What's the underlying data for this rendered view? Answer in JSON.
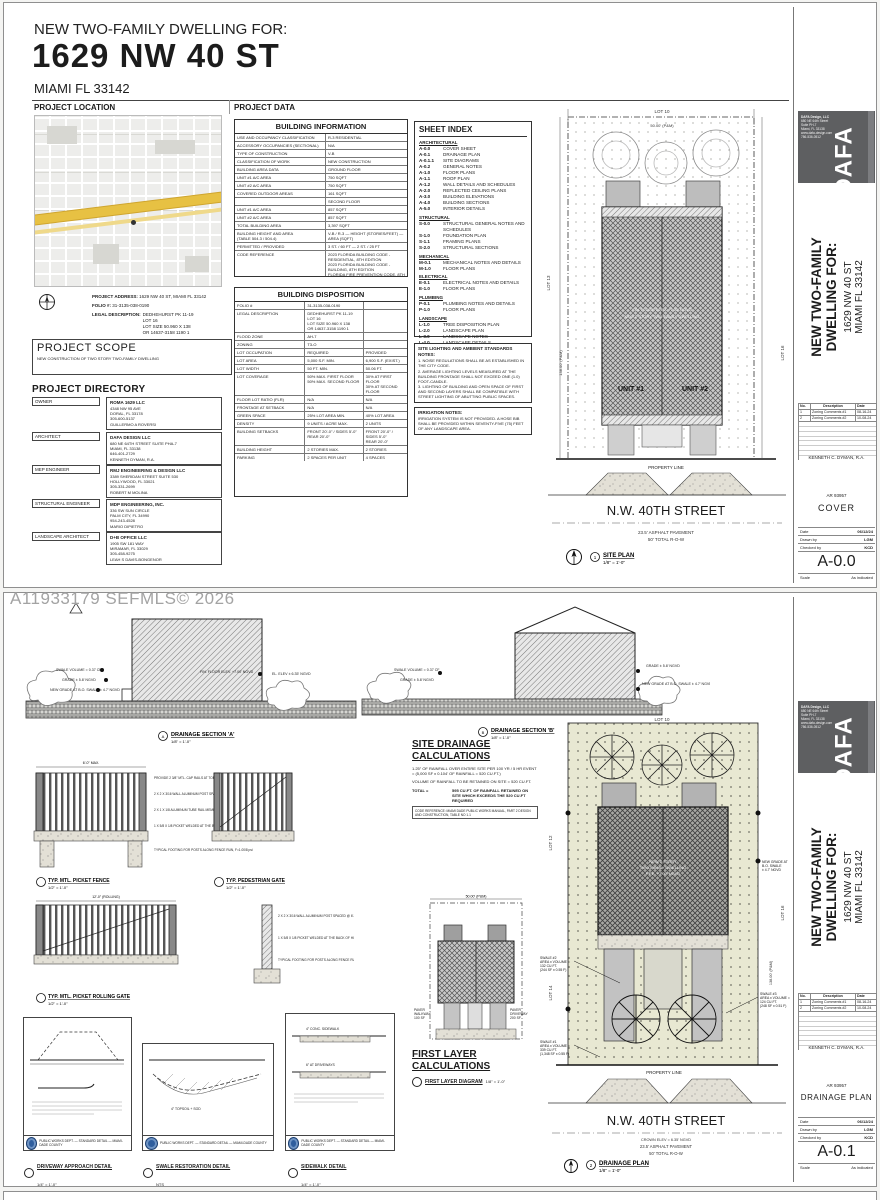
{
  "watermark": "A11933179  SEFMLS© 2026",
  "header": {
    "pretitle": "NEW TWO-FAMILY DWELLING FOR:",
    "title": "1629 NW 40 ST",
    "subtitle": "MIAMI FL 33142",
    "section_left": "PROJECT LOCATION",
    "section_right": "PROJECT DATA"
  },
  "project_info": {
    "address_label": "PROJECT ADDRESS:",
    "address": "1629 NW 40 ST, MIAMI FL 33142",
    "folio_label": "FOLIO #:",
    "folio": "31-3135-038-0190",
    "legal_label": "LEGAL DESCRIPTION:",
    "legal": "DEDHEHURST PK 11-19\nLOT 16\nLOT SIZE 50.960 X 138\nOR 14637-3158 1190 1"
  },
  "project_scope": {
    "title": "PROJECT SCOPE",
    "text": "NEW CONSTRUCTION OF TWO STORY TWO-FAMILY DWELLING"
  },
  "project_directory": {
    "title": "PROJECT DIRECTORY",
    "entries": [
      {
        "role": "OWNER",
        "name": "ROMA 1629 LLC",
        "lines": "4348 NW 95 AVE\nDORAL, FL 33178\n305-600-5137\nGUILLERMO A ROVERSI"
      },
      {
        "role": "ARCHITECT",
        "name": "DAFA DESIGN LLC",
        "lines": "680 NE 64TH STREET SUITE PHA-7\nMIAMI, FL 33138\n646-401-2729\nKENNETH DYMAN, R.A."
      },
      {
        "role": "MEP ENGINEER",
        "name": "RMJ ENGINEERING & DESIGN LLC",
        "lines": "3389 SHERIDAN STREET SUITE 530\nHOLLYWOOD, FL 33021\n305-331-2699\nROBERT M MOLINA"
      },
      {
        "role": "STRUCTURAL ENGINEER",
        "name": "MDP ENGINEERING, INC.",
        "lines": "336 SW SUN CIRCLE\nPALM CITY, FL 34990\n954-243-4528\nMARIO DIPIETRO"
      },
      {
        "role": "LANDSCAPE ARCHITECT",
        "name": "D+B OFFICE LLC",
        "lines": "1905 SW 181 WAY\nMIRAMAR, FL 33029\n305-458-9275\nLEAH S DAVIS-BONGENOR"
      }
    ]
  },
  "building_information": {
    "title": "BUILDING INFORMATION",
    "rows": [
      [
        "USE AND OCCUPANCY CLASSIFICATION",
        "R-3 RESIDENTIAL"
      ],
      [
        "ACCESSORY OCCUPANCIES (SECTIONAL)",
        "N/A"
      ],
      [
        "TYPE OF CONSTRUCTION",
        "V-B"
      ],
      [
        "CLASSIFICATION OF WORK",
        "NEW CONSTRUCTION"
      ],
      [
        "BUILDING AREA DATA",
        "GROUND FLOOR"
      ],
      [
        "UNIT #1 A/C AREA",
        "750 SQFT"
      ],
      [
        "UNIT #2 A/C AREA",
        "750 SQFT"
      ],
      [
        "COVERED OUTDOOR AREAS",
        "161 SQFT"
      ],
      [
        "",
        "SECOND FLOOR"
      ],
      [
        "UNIT #1 A/C AREA",
        "857 SQFT"
      ],
      [
        "UNIT #2 A/C AREA",
        "857 SQFT"
      ],
      [
        "TOTAL BUILDING AREA",
        "3,397 SQFT"
      ],
      [
        "BUILDING HEIGHT AND AREA\n(TABLE 504.3 / 504.4)",
        "V-B / R-3  —  HEIGHT (STORIES/FEET)  —  AREA (SQFT)"
      ],
      [
        "PERMITTED / PROVIDED",
        "3 ST. / 60 FT  —  2 ST. / 25 FT"
      ],
      [
        "CODE REFERENCE",
        "2023 FLORIDA BUILDING CODE - RESIDENTIAL, 8TH EDITION\n2023 FLORIDA BUILDING CODE - BUILDING, 8TH EDITION\nFLORIDA FIRE PREVENTION CODE, 8TH EDITION"
      ]
    ]
  },
  "building_disposition": {
    "title": "BUILDING DISPOSITION",
    "rows": [
      [
        "FOLIO #",
        "31-3135-038-0190",
        ""
      ],
      [
        "LEGAL DESCRIPTION",
        "DEDHEHURST PK 11-19\nLOT 16\nLOT SIZE 50.960 X 138\nOR 14637-3158 1190 1",
        ""
      ],
      [
        "FLOOD ZONE",
        "AH-7",
        ""
      ],
      [
        "ZONING",
        "T3-O",
        ""
      ],
      [
        "LOT OCCUPATION",
        "REQUIRED",
        "PROVIDED"
      ],
      [
        "LOT AREA",
        "5,000 S.F. MIN.",
        "6,900 S.F. (EXIST.)"
      ],
      [
        "LOT WIDTH",
        "50 FT. MIN.",
        "50.06 FT."
      ],
      [
        "LOT COVERAGE",
        "50% MAX. FIRST FLOOR\n50% MAX. SECOND FLOOR",
        "30% AT FIRST FLOOR\n30% AT SECOND FLOOR"
      ],
      [
        "FLOOR LOT RATIO (FLR)",
        "N/A",
        "N/A"
      ],
      [
        "FRONTAGE AT SETBACK",
        "N/A",
        "N/A"
      ],
      [
        "GREEN SPACE",
        "25% LOT AREA MIN.",
        "40% LOT AREA"
      ],
      [
        "DENSITY",
        "9 UNITS / ACRE MAX.",
        "2 UNITS"
      ],
      [
        "BUILDING SETBACKS",
        "FRONT 20'-0\" / SIDES 5'-0\"\nREAR 20'-0\"",
        "FRONT 20'-0\" / SIDES 5'-0\"\nREAR 20'-0\""
      ],
      [
        "BUILDING HEIGHT",
        "2 STORIES MAX.",
        "2 STORIES"
      ],
      [
        "PARKING",
        "2 SPACES PER UNIT",
        "4 SPACES"
      ]
    ]
  },
  "sheet_index": {
    "title": "SHEET INDEX",
    "groups": [
      {
        "heading": "ARCHITECTURAL",
        "items": [
          [
            "A-0.0",
            "COVER SHEET"
          ],
          [
            "A-0.1",
            "DRAINAGE PLAN"
          ],
          [
            "A-0.1.1",
            "SITE DIAGRAMS"
          ],
          [
            "A-0.2",
            "GENERAL NOTES"
          ],
          [
            "A-1.0",
            "FLOOR PLANS"
          ],
          [
            "A-1.1",
            "ROOF PLAN"
          ],
          [
            "A-1.2",
            "WALL DETAILS AND SCHEDULES"
          ],
          [
            "A-2.0",
            "REFLECTED CEILING PLANS"
          ],
          [
            "A-3.0",
            "BUILDING ELEVATIONS"
          ],
          [
            "A-4.0",
            "BUILDING SECTIONS"
          ],
          [
            "A-5.0",
            "INTERIOR DETAILS"
          ]
        ]
      },
      {
        "heading": "STRUCTURAL",
        "items": [
          [
            "S-0.0",
            "STRUCTURAL GENERAL NOTES AND SCHEDULES"
          ],
          [
            "S-1.0",
            "FOUNDATION PLAN"
          ],
          [
            "S-1.1",
            "FRAMING PLANS"
          ],
          [
            "S-2.0",
            "STRUCTURAL SECTIONS"
          ]
        ]
      },
      {
        "heading": "MECHANICAL",
        "items": [
          [
            "M-0.1",
            "MECHANICAL NOTES AND DETAILS"
          ],
          [
            "M-1.0",
            "FLOOR PLANS"
          ]
        ]
      },
      {
        "heading": "ELECTRICAL",
        "items": [
          [
            "E-0.1",
            "ELECTRICAL NOTES AND DETAILS"
          ],
          [
            "E-1.0",
            "FLOOR PLANS"
          ]
        ]
      },
      {
        "heading": "PLUMBING",
        "items": [
          [
            "P-0.1",
            "PLUMBING NOTES AND DETAILS"
          ],
          [
            "P-1.0",
            "FLOOR PLANS"
          ]
        ]
      },
      {
        "heading": "LANDSCAPE",
        "items": [
          [
            "L-1.0",
            "TREE DISPOSITION PLAN"
          ],
          [
            "L-2.0",
            "LANDSCAPE PLAN"
          ],
          [
            "L-3.0",
            "LANDSCAPE NOTES"
          ],
          [
            "L-4.0",
            "LANDSCAPE DETAILS"
          ]
        ]
      }
    ]
  },
  "site_notes": {
    "title": "SITE LIGHTING AND AMBIENT STANDARDS NOTES:",
    "text": "1. NOISE REGULATIONS SHALL BE AS ESTABLISHED IN THE CITY CODE.\n2. AVERAGE LIGHTING LEVELS MEASURED AT THE BUILDING FRONTAGE SHALL NOT EXCEED ONE (1.0) FOOT-CANDLE.\n3. LIGHTING OF BUILDING AND OPEN SPACE OF FIRST AND SECOND LAYERS SHALL BE COMPATIBLE WITH STREET LIGHTING OF ABUTTING PUBLIC SPACES."
  },
  "irrigation_notes": {
    "title": "IRRIGATION NOTES:",
    "text": "IRRIGATION SYSTEM IS NOT PROVIDED. A HOSE BIB SHALL BE PROVIDED WITHIN SEVENTY-FIVE (75) FEET OF ANY LANDSCAPE AREA."
  },
  "site_plan": {
    "unit1": "UNIT #1",
    "unit2": "UNIT #2",
    "building_note": "NEW 2 STORY\nTWO-FAMILY DWELLING\nF.F.E. +7.00' NGVD",
    "property_line": "PROPERTY LINE",
    "street": "N.W. 40TH STREET",
    "pavement": "23.5' ASPHALT PAVEMENT",
    "row": "50' TOTAL R-O-W",
    "lot_top": "LOT 10",
    "lot_left": "LOT 13",
    "lot_right": "LOT 16",
    "dim_top": "50.00' (P&M)",
    "dim_side": "138.00' (P&M)",
    "label": "SITE PLAN",
    "scale": "1/8\" = 1'-0\"",
    "callout_num": "1"
  },
  "titleblock": {
    "logo_firm": "DAFA Design, LLC",
    "logo_lines": "680 NE 64th Street\nSuite PH-7\nMiami, FL 33138\nwww.dafa-design.com\n786-536-0512",
    "logo_mark": "DAFA",
    "project1": "NEW TWO-FAMILY",
    "project2": "DWELLING FOR:",
    "address1": "1629 NW 40 ST",
    "address2": "MIAMI FL 33142",
    "rev_header": [
      "No.",
      "Description",
      "Date"
    ],
    "revisions": [
      [
        "1",
        "Zoning Comments #1",
        "08-16-24"
      ],
      [
        "2",
        "Zoning Comments #2",
        "10-08-24"
      ]
    ],
    "architect": "KENNETH C. DYMAN,  R.A.",
    "license": "AR 93957",
    "sheet1_name": "COVER",
    "sheet1_no": "A-0.0",
    "sheet2_name": "DRAINAGE PLAN",
    "sheet2_no": "A-0.1",
    "date_label": "Date",
    "date": "06/12/24",
    "drawn_label": "Drawn by",
    "drawn": "LGM",
    "checked_label": "Checked by",
    "checked": "KCD",
    "scale_label": "Scale",
    "scale": "As indicated"
  },
  "sections": {
    "a_title": "DRAINAGE SECTION 'A'",
    "a_scale": "1/8\" = 1'-0\"",
    "b_title": "DRAINAGE SECTION 'B'",
    "b_scale": "1/8\" = 1'-0\"",
    "note_swale": "SWALE VOLUME = 0.37 CF",
    "note_grade": "GRADE ± 5.8' NGVD",
    "note_newgrade": "NEW GRADE AT B.O. SWALE ± 4.7' NGVD",
    "note_ffe": "FIN. FLOOR ELEV. +7.00' NGVD",
    "note_elev": "EL. ELEV ± 6.35' NGVD"
  },
  "fence_details": {
    "d1_title": "TYP. MTL. PICKET FENCE",
    "d1_scale": "1/2\" = 1'-0\"",
    "d2_title": "TYP. PEDESTRIAN GATE",
    "d2_scale": "1/2\" = 1'-0\"",
    "d3_title": "TYP. MTL. PICKET ROLLING GATE",
    "d3_scale": "1/2\" = 1'-0\"",
    "note1": "PROVIDE 2 3/8\" MTL. CAP RAILS AT TOP AND BOTTOM OF PICKETS",
    "note2": "2 X 2 X 3/16 WALL ALUMINUM POST SPACED @ 6'-0\" MAX. O.C.",
    "note3": "2 X 1 X 1/8 ALUMINUM TUBE RAIL MEMBER",
    "note4": "1 X 5/8 X 1/8 PICKET WELDED AT THE BACK OF HORIZONTAL TUBE, TYP.",
    "note5": "TYPICAL FOOTING FOR POSTS ALONG FENCE RUN, F=1.00/8 psi"
  },
  "drainage_calc": {
    "title1": "SITE DRAINAGE",
    "title2": "CALCULATIONS",
    "intro1": "1.25\" OF RAINFALL OVER ENTIRE SITE PER 100 YR / 5 HR EVENT = (5,000 SF x 0.104' OF RAINFALL = 520 CU.FT.)",
    "intro2": "VOLUME OF RAINFALL TO BE RETAINED ON SITE = 520 CU.FT.",
    "swales": [
      [
        "SWALE #1 =",
        "339 CU.FT.",
        "(1,348 SF x 0.55 F)"
      ],
      [
        "SWALE #2 =",
        "132 CU.FT.",
        "(244 SF x 0.55 F)"
      ],
      [
        "SWALE #3 =",
        "124 CU.FT.",
        "(242 SF x 0.51 F)"
      ]
    ],
    "total_label": "TOTAL =",
    "total_text": "595 CU.FT. OF RAINFALL RETAINED ON SITE WHICH EXCEEDS THE 520 CU.FT REQUIRED",
    "code_ref": "CODE REFERENCE:   MIAMI DADE PUBLIC WORKS MANUAL, PART 2 DESIGN AND CONSTRUCTION, TABLE NO 1.1"
  },
  "first_layer": {
    "title1": "FIRST LAYER",
    "title2": "CALCULATIONS",
    "rows": [
      [
        "TOTAL FIRST LAYER AREA",
        "1,000 SF"
      ],
      [
        "IMPERVIOUS/PERVIOUS PAVEMENT:",
        ""
      ],
      [
        "PAVER DRIVEWAY",
        "400 SF"
      ],
      [
        "PAVER WALKWAY",
        "100 SF"
      ],
      [
        "TOTAL",
        "500 SF"
      ],
      [
        "IMPERVIOUS/PERVIOUS %\n(500 SF / 1,000 SF)",
        "50%"
      ]
    ],
    "diagram_dim": "50.00' (P&M)",
    "paver_driveway": "PAVER\nDRIVEWAY\n200 SF",
    "paver_walkway": "PAVER\nWALKWAY\n100 SF",
    "diagram_label": "FIRST LAYER DIAGRAM",
    "diagram_scale": "1/8\" = 1'-0\""
  },
  "drainage_plan": {
    "building_note": "NEW 2 STORY\nTWO-FAMILY DWELLING\nF.F.E. +7.00' NGVD",
    "property_line": "PROPERTY LINE",
    "street": "N.W. 40TH STREET",
    "crown": "CROWN ELEV = 6.35' NGVD",
    "pavement": "23.5' ASPHALT PAVEMENT",
    "row": "50' TOTAL R-O-W",
    "lot_top": "LOT 10",
    "lot_left_up": "LOT 12",
    "lot_left_dn": "LOT 14",
    "lot_right": "LOT 16",
    "dim_side": "138.00' (P&M)",
    "swale1": "SWALE #1\nAREA x VOLUME =\n339 CU.FT.\n(1,348 SF x 0.55 F)",
    "swale2": "SWALE #2\nAREA x VOLUME =\n132 CU.FT.\n(244 SF x 0.55 F)",
    "swale3": "SWALE #3\nAREA x VOLUME =\n124 CU.FT.\n(248 SF x 0.51 F)",
    "grade_note": "NEW GRADE AT\nB.O. SWALE\n± 4.7' NGVD",
    "label": "DRAINAGE PLAN",
    "scale": "1/8\" = 1'-0\"",
    "callout_num": "2"
  },
  "bottom_details": [
    {
      "title": "DRIVEWAY APPROACH DETAIL",
      "scale": "1/4\" = 1'-0\"",
      "bar": "PUBLIC WORKS DEPT. — STANDARD DETAIL — MIAMI-DADE COUNTY"
    },
    {
      "title": "SWALE RESTORATION DETAIL",
      "scale": "NTS",
      "bar": "PUBLIC WORKS DEPT. — STANDARD DETAIL — MIAMI-DADE COUNTY"
    },
    {
      "title": "SIDEWALK DETAIL",
      "scale": "1/4\" = 1'-0\"",
      "bar": "PUBLIC WORKS DEPT. — STANDARD DETAIL — MIAMI-DADE COUNTY"
    }
  ]
}
